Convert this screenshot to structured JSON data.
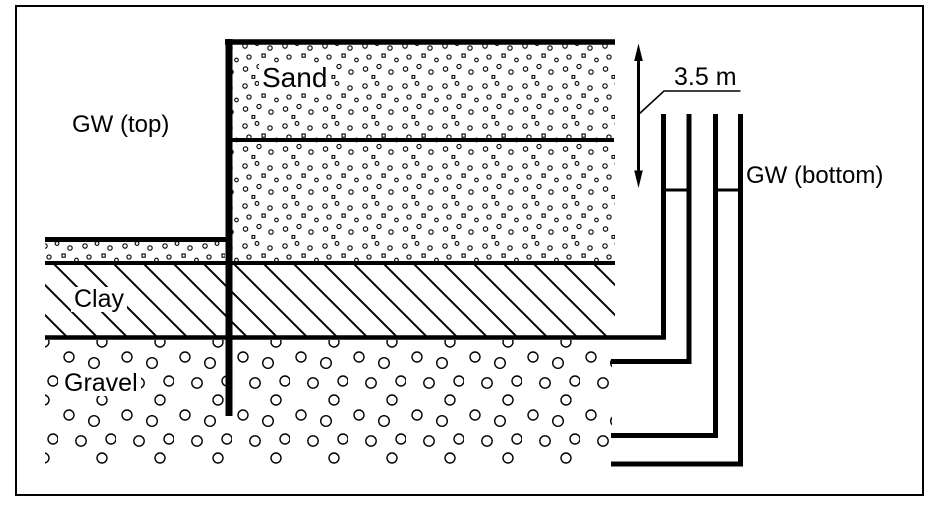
{
  "figure": {
    "type": "soil-cross-section",
    "background_color": "#ffffff",
    "line_color": "#000000",
    "labels": {
      "gw_top": "GW (top)",
      "sand": "Sand",
      "clay": "Clay",
      "gravel": "Gravel",
      "dimension": "3.5 m",
      "gw_bottom": "GW (bottom)"
    },
    "soil_layers": [
      "Sand",
      "Clay",
      "Gravel"
    ],
    "groundwater_levels": [
      "GW (top)",
      "GW (bottom)"
    ],
    "head_difference": "3.5 m",
    "standpipes": 2
  }
}
